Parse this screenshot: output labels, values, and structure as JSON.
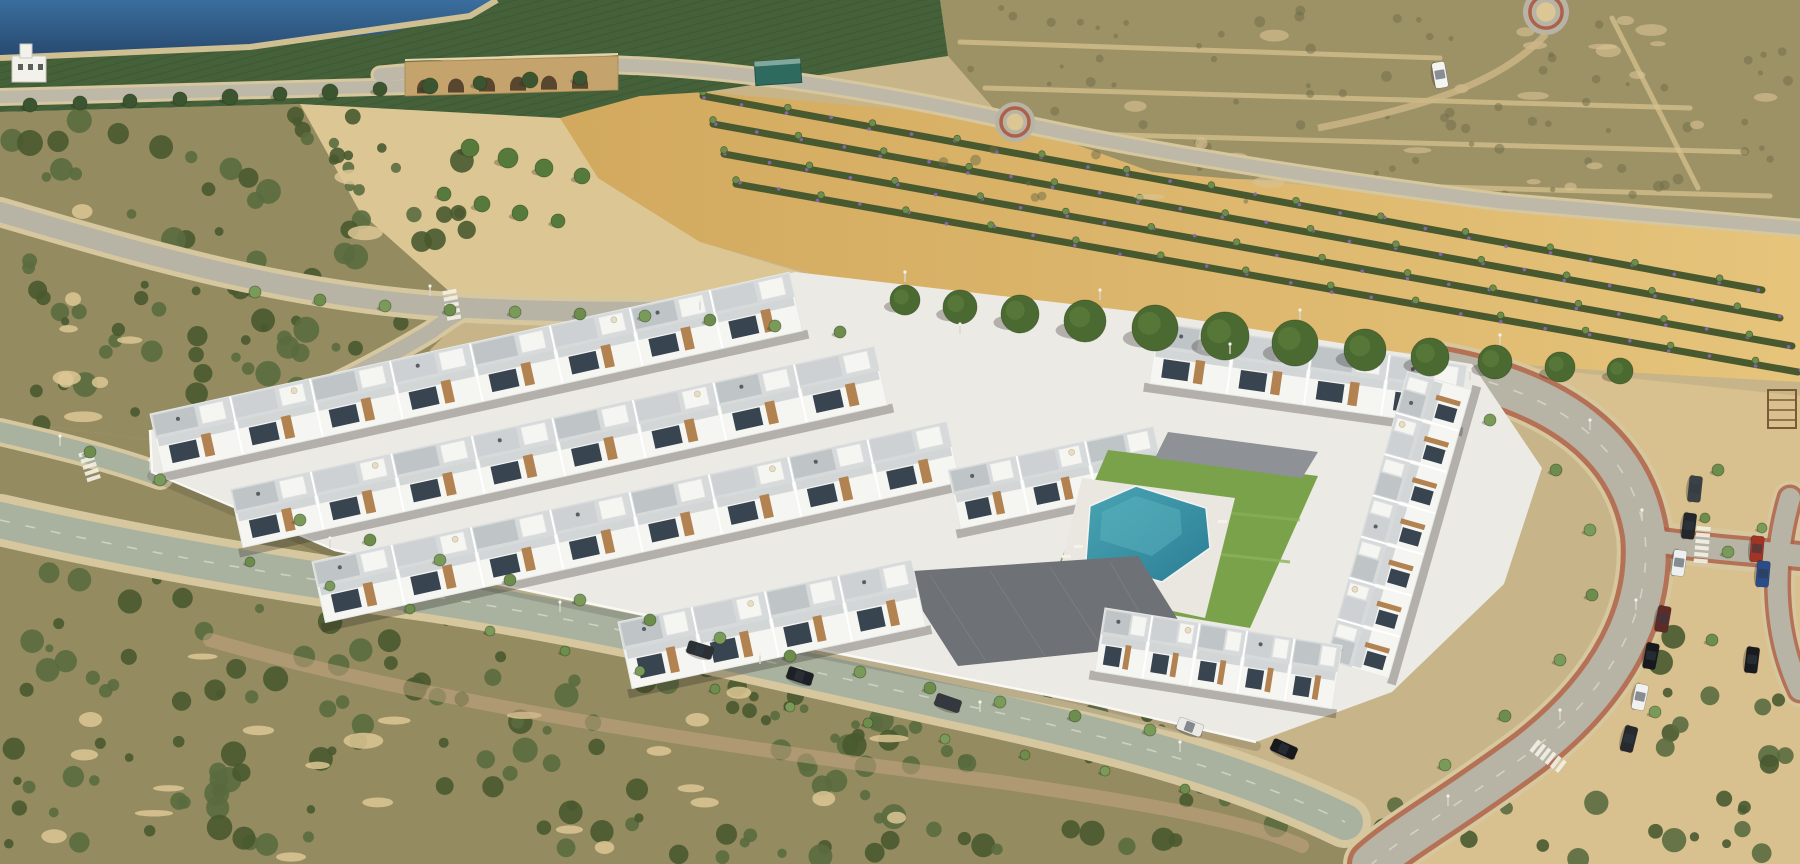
{
  "scene": {
    "description": "Aerial 3D render of a new white Mediterranean townhouse development with a communal turquoise pool, tree-lined streets with parked cars, surrounded by scrubland, golden farm fields, orchards, a water reservoir and an old arched stone bridge",
    "setting": "semi-arid coastal plain, daytime",
    "media": "architectural render composited onto aerial photograph"
  },
  "palette": {
    "sand": "#c7b488",
    "sandLight": "#dcc794",
    "scrub": "#948b60",
    "scrubTop": "#9d9166",
    "field1": "#e6c47b",
    "field2": "#d2a95e",
    "orchard": "#45613a",
    "orchardDark": "#384f2e",
    "water1": "#3a6e9e",
    "water2": "#27496f",
    "waterEdge": "#cfc093",
    "road": "#b7b4a5",
    "roadGreen": "#a9b29f",
    "sidewalk": "#d6c79e",
    "redside": "#ae6149",
    "stone": "#c4a46c",
    "arch": "#4e3e29",
    "bush1": "#5a6c3f",
    "bush2": "#49592f",
    "tree": "#6d8d4d",
    "pine": "#4a6a31",
    "lawn": "#7aa24b",
    "pool1": "#49a5b3",
    "pool2": "#2c7e95",
    "white": "#f5f5f2",
    "shade": "#e4e4df",
    "roof": "#d7dadb",
    "roof2": "#cdd1d3",
    "terrace": "#bfc4c7",
    "window": "#38444f",
    "wood": "#b28350",
    "deck": "#6e7176",
    "deck2": "#8e9296",
    "wall": "#fbfbf9",
    "shadow": "rgba(45,44,36,0.30)"
  },
  "counts": {
    "townhouse_rows": 8,
    "parked_cars": 16,
    "street_trees": 51,
    "pine_trees": 12,
    "roundabouts": 2,
    "bridge_arches": 6
  },
  "objects": {
    "rows": [
      {
        "x": 150,
        "y": 414,
        "len": 655,
        "depth": 60,
        "angle": -12.5,
        "units": 8,
        "layer": "back"
      },
      {
        "x": 230,
        "y": 489,
        "len": 660,
        "depth": 60,
        "angle": -12.5,
        "units": 8,
        "layer": "back"
      },
      {
        "x": 1158,
        "y": 322,
        "len": 312,
        "depth": 62,
        "angle": 8,
        "units": 4,
        "layer": "back"
      },
      {
        "x": 312,
        "y": 562,
        "len": 650,
        "depth": 62,
        "angle": -12.5,
        "units": 8,
        "layer": "back"
      },
      {
        "x": 948,
        "y": 470,
        "len": 210,
        "depth": 60,
        "angle": -12,
        "units": 3,
        "layer": "back"
      },
      {
        "x": 1325,
        "y": 660,
        "len": 300,
        "depth": 66,
        "angle": -74,
        "units": 7,
        "layer": "front"
      },
      {
        "x": 1105,
        "y": 608,
        "len": 240,
        "depth": 64,
        "angle": 9,
        "units": 5,
        "layer": "front"
      },
      {
        "x": 618,
        "y": 622,
        "len": 300,
        "depth": 68,
        "angle": -12,
        "units": 4,
        "layer": "front"
      }
    ],
    "flower_rows": [
      [
        703,
        96,
        1762,
        290
      ],
      [
        713,
        124,
        1780,
        318
      ],
      [
        724,
        154,
        1792,
        346
      ],
      [
        736,
        184,
        1798,
        372
      ]
    ],
    "scatter": [
      {
        "x": 0,
        "y": 115,
        "w": 470,
        "h": 330,
        "n": 110,
        "kind": "bush"
      },
      {
        "x": 0,
        "y": 560,
        "w": 900,
        "h": 300,
        "n": 150,
        "kind": "bush"
      },
      {
        "x": 700,
        "y": 680,
        "w": 620,
        "h": 180,
        "n": 55,
        "kind": "bush"
      },
      {
        "x": 1380,
        "y": 790,
        "w": 420,
        "h": 70,
        "n": 16,
        "kind": "bush"
      },
      {
        "x": 1660,
        "y": 620,
        "w": 140,
        "h": 150,
        "n": 12,
        "kind": "bush"
      },
      {
        "x": 0,
        "y": 580,
        "w": 900,
        "h": 280,
        "n": 26,
        "kind": "sand"
      },
      {
        "x": 40,
        "y": 150,
        "w": 400,
        "h": 280,
        "n": 14,
        "kind": "sand"
      },
      {
        "x": 930,
        "y": 8,
        "w": 860,
        "h": 195,
        "n": 85,
        "kind": "blotch"
      },
      {
        "x": 980,
        "y": 20,
        "w": 800,
        "h": 180,
        "n": 22,
        "kind": "sandtop"
      }
    ],
    "pines": [
      [
        905,
        300,
        15
      ],
      [
        960,
        307,
        17
      ],
      [
        1020,
        314,
        19
      ],
      [
        1085,
        321,
        21
      ],
      [
        1155,
        328,
        23
      ],
      [
        1225,
        336,
        24
      ],
      [
        1295,
        343,
        23
      ],
      [
        1365,
        350,
        21
      ],
      [
        1430,
        357,
        19
      ],
      [
        1495,
        362,
        17
      ],
      [
        1560,
        367,
        15
      ],
      [
        1620,
        371,
        13
      ]
    ],
    "street_trees": [
      [
        255,
        292,
        6
      ],
      [
        320,
        300,
        6
      ],
      [
        385,
        306,
        6
      ],
      [
        450,
        310,
        6
      ],
      [
        515,
        312,
        6
      ],
      [
        580,
        314,
        6
      ],
      [
        645,
        316,
        6
      ],
      [
        710,
        320,
        6
      ],
      [
        775,
        326,
        6
      ],
      [
        840,
        332,
        6
      ],
      [
        300,
        520,
        6
      ],
      [
        370,
        540,
        6
      ],
      [
        440,
        560,
        6
      ],
      [
        510,
        580,
        6
      ],
      [
        580,
        600,
        6
      ],
      [
        650,
        620,
        6
      ],
      [
        720,
        638,
        6
      ],
      [
        790,
        656,
        6
      ],
      [
        860,
        672,
        6
      ],
      [
        930,
        688,
        6
      ],
      [
        1000,
        702,
        6
      ],
      [
        1075,
        716,
        6
      ],
      [
        1150,
        730,
        6
      ],
      [
        250,
        562,
        5
      ],
      [
        330,
        586,
        5
      ],
      [
        410,
        609,
        5
      ],
      [
        490,
        631,
        5
      ],
      [
        565,
        651,
        5
      ],
      [
        640,
        671,
        5
      ],
      [
        715,
        689,
        5
      ],
      [
        790,
        707,
        5
      ],
      [
        868,
        723,
        5
      ],
      [
        945,
        739,
        5
      ],
      [
        1025,
        755,
        5
      ],
      [
        1105,
        771,
        5
      ],
      [
        1185,
        789,
        5
      ],
      [
        1490,
        420,
        6
      ],
      [
        1556,
        470,
        6
      ],
      [
        1590,
        530,
        6
      ],
      [
        1592,
        595,
        6
      ],
      [
        1560,
        660,
        6
      ],
      [
        1505,
        716,
        6
      ],
      [
        1445,
        765,
        6
      ],
      [
        1718,
        470,
        6
      ],
      [
        1728,
        552,
        6
      ],
      [
        1712,
        640,
        6
      ],
      [
        1655,
        712,
        6
      ],
      [
        1705,
        518,
        5
      ],
      [
        1762,
        528,
        5
      ],
      [
        90,
        452,
        6
      ],
      [
        160,
        480,
        6
      ]
    ],
    "bridge_trees": [
      [
        470,
        148,
        9
      ],
      [
        508,
        158,
        10
      ],
      [
        544,
        168,
        9
      ],
      [
        582,
        176,
        8
      ],
      [
        444,
        194,
        7
      ],
      [
        482,
        204,
        8
      ],
      [
        520,
        213,
        8
      ],
      [
        558,
        221,
        7
      ]
    ],
    "orchard_edge_trees": [
      [
        30,
        105,
        7
      ],
      [
        80,
        103,
        7
      ],
      [
        130,
        101,
        7
      ],
      [
        180,
        99,
        7
      ],
      [
        230,
        97,
        8
      ],
      [
        280,
        94,
        7
      ],
      [
        330,
        92,
        8
      ],
      [
        380,
        89,
        7
      ],
      [
        430,
        86,
        8
      ],
      [
        480,
        83,
        7
      ],
      [
        530,
        80,
        8
      ],
      [
        580,
        78,
        7
      ]
    ],
    "cars": [
      {
        "x": 700,
        "y": 650,
        "a": 17,
        "c": "#2c2f33"
      },
      {
        "x": 800,
        "y": 676,
        "a": 18,
        "c": "#1d2024"
      },
      {
        "x": 948,
        "y": 703,
        "a": 19,
        "c": "#35383c"
      },
      {
        "x": 1190,
        "y": 727,
        "a": 20,
        "c": "#e9e9e6"
      },
      {
        "x": 1284,
        "y": 749,
        "a": 24,
        "c": "#17191c"
      },
      {
        "x": 1695,
        "y": 489,
        "a": 96,
        "c": "#3c4146"
      },
      {
        "x": 1689,
        "y": 526,
        "a": 97,
        "c": "#24272b"
      },
      {
        "x": 1679,
        "y": 563,
        "a": 98,
        "c": "#eef0f0"
      },
      {
        "x": 1663,
        "y": 619,
        "a": 100,
        "c": "#5e2b28"
      },
      {
        "x": 1651,
        "y": 656,
        "a": 101,
        "c": "#17191c"
      },
      {
        "x": 1640,
        "y": 697,
        "a": 102,
        "c": "#f1f1ef"
      },
      {
        "x": 1629,
        "y": 739,
        "a": 104,
        "c": "#27292c"
      },
      {
        "x": 1757,
        "y": 549,
        "a": 95,
        "c": "#a23425"
      },
      {
        "x": 1763,
        "y": 574,
        "a": 95,
        "c": "#2a4c88"
      },
      {
        "x": 1752,
        "y": 660,
        "a": 97,
        "c": "#191b1e"
      },
      {
        "x": 1440,
        "y": 75,
        "a": 80,
        "c": "#f4f4f2"
      }
    ],
    "lamps": [
      [
        430,
        296
      ],
      [
        700,
        310
      ],
      [
        960,
        334
      ],
      [
        1230,
        354
      ],
      [
        1470,
        380
      ],
      [
        1590,
        430
      ],
      [
        1642,
        520
      ],
      [
        1636,
        610
      ],
      [
        1560,
        720
      ],
      [
        1448,
        806
      ],
      [
        150,
        470
      ],
      [
        330,
        548
      ],
      [
        560,
        612
      ],
      [
        760,
        664
      ],
      [
        980,
        712
      ],
      [
        1180,
        752
      ],
      [
        60,
        446
      ],
      [
        905,
        282
      ],
      [
        1100,
        300
      ],
      [
        1300,
        320
      ],
      [
        1500,
        345
      ]
    ],
    "crosswalks": [
      {
        "x": 90,
        "y": 467,
        "a": 72,
        "n": 5
      },
      {
        "x": 452,
        "y": 306,
        "a": 80,
        "n": 5
      },
      {
        "x": 1702,
        "y": 546,
        "a": 95,
        "n": 6
      },
      {
        "x": 1549,
        "y": 757,
        "a": 38,
        "n": 6
      }
    ],
    "roundabouts": [
      {
        "x": 1015,
        "y": 122,
        "r": 20
      },
      {
        "x": 1546,
        "y": 12,
        "r": 23
      }
    ],
    "bridge": {
      "x1": 405,
      "x2": 618,
      "ytop": 58,
      "h": 36,
      "arches": 6
    },
    "pool": {
      "shape": "irregular hexagon",
      "water": "turquoise"
    },
    "greenhouse_shed": {
      "x": 755,
      "y": 60,
      "w": 46,
      "h": 24,
      "angle": -4
    },
    "pump_house": {
      "x": 12,
      "y": 56,
      "w": 34,
      "h": 26
    },
    "pergola": {
      "x": 1768,
      "y": 390,
      "w": 28,
      "h": 38
    }
  }
}
